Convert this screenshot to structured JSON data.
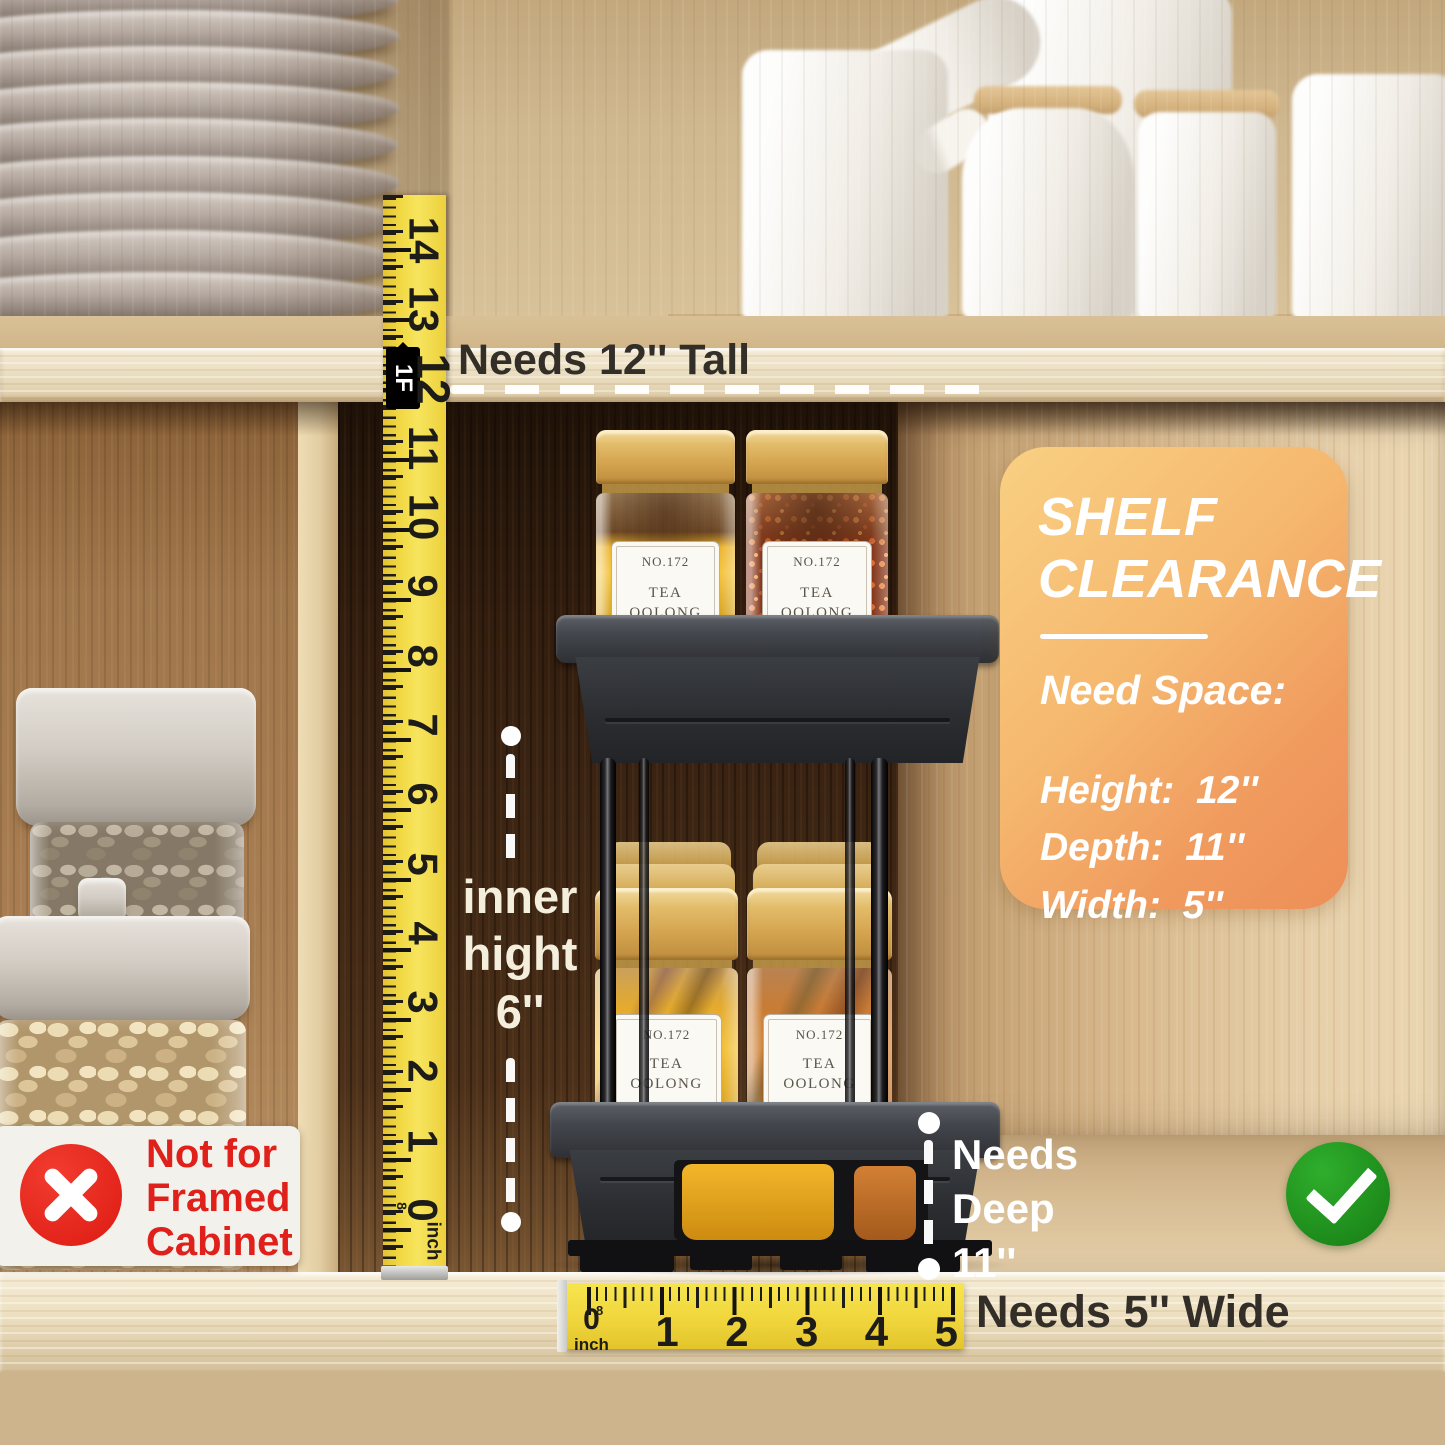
{
  "annotations": {
    "needs_tall": "Needs 12'' Tall",
    "inner_height": [
      "inner",
      "hight",
      "6''"
    ],
    "needs_deep": [
      "Needs",
      "Deep",
      "11''"
    ],
    "needs_wide": "Needs 5'' Wide",
    "not_for_framed": [
      "Not for",
      "Framed",
      "Cabinet"
    ]
  },
  "clearance_card": {
    "title": [
      "SHELF",
      "CLEARANCE"
    ],
    "subtitle": "Need Space:",
    "specs": [
      "Height:  12''",
      "Depth:  11''",
      "Width:  5''"
    ]
  },
  "rulers": {
    "vertical": {
      "numbers": [
        "14",
        "13",
        "12",
        "11",
        "10",
        "9",
        "8",
        "7",
        "6",
        "5",
        "4",
        "3",
        "2",
        "1",
        "0"
      ],
      "foot_marker": "1F",
      "unit": "inch",
      "fraction": "8"
    },
    "horizontal": {
      "numbers": [
        "0",
        "1",
        "2",
        "3",
        "4",
        "5"
      ],
      "unit": "inch",
      "fraction": "8"
    }
  },
  "spice_jar_label": {
    "no": "NO.172",
    "name_line1": "TEA",
    "name_line2": "OOLONG",
    "sub": "HERB"
  },
  "symbols": {
    "cross": "not-allowed",
    "check": "allowed"
  },
  "colors": {
    "card_gradient_start": "#f9d083",
    "card_gradient_end": "#ed8f58",
    "ruler_yellow": "#f2da45",
    "check_green": "#1b8a1b",
    "cross_red": "#e7231b",
    "warning_text_red": "#e0201a",
    "annotation_white": "#ffffff",
    "dark_wood": "#3f2714",
    "light_wood": "#e6cfa9"
  }
}
